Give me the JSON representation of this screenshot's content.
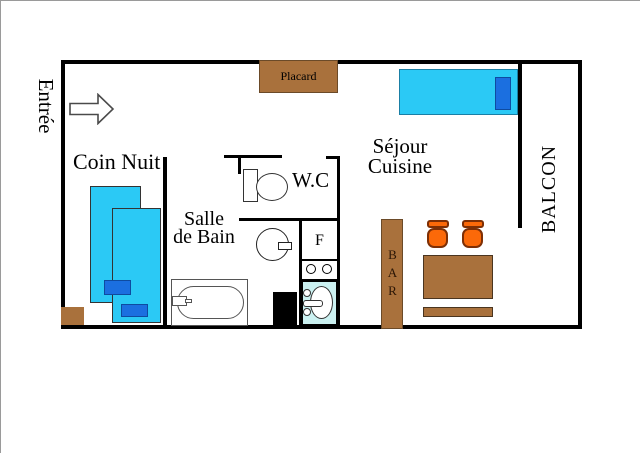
{
  "diagram": {
    "type": "apartment-floor-plan",
    "labels": {
      "entrance": "Entrée",
      "sleeping_area": "Coin Nuit",
      "bathroom_line1": "Salle",
      "bathroom_line2": "de Bain",
      "wc": "W.C",
      "living_line1": "Séjour",
      "living_line2": "Cuisine",
      "balcony": "BALCON",
      "closet": "Placard",
      "fridge": "F",
      "bar": "BAR"
    },
    "colors": {
      "wall": "#000000",
      "wood": "#A9713C",
      "bed_cyan": "#2BC9F5",
      "pillow_blue": "#1B6FE0",
      "stool_orange": "#FB6909",
      "stool_outline": "#7E2F05",
      "kitchen_sink_cyan": "#CBF1F1",
      "appliance_black": "#000000"
    }
  }
}
